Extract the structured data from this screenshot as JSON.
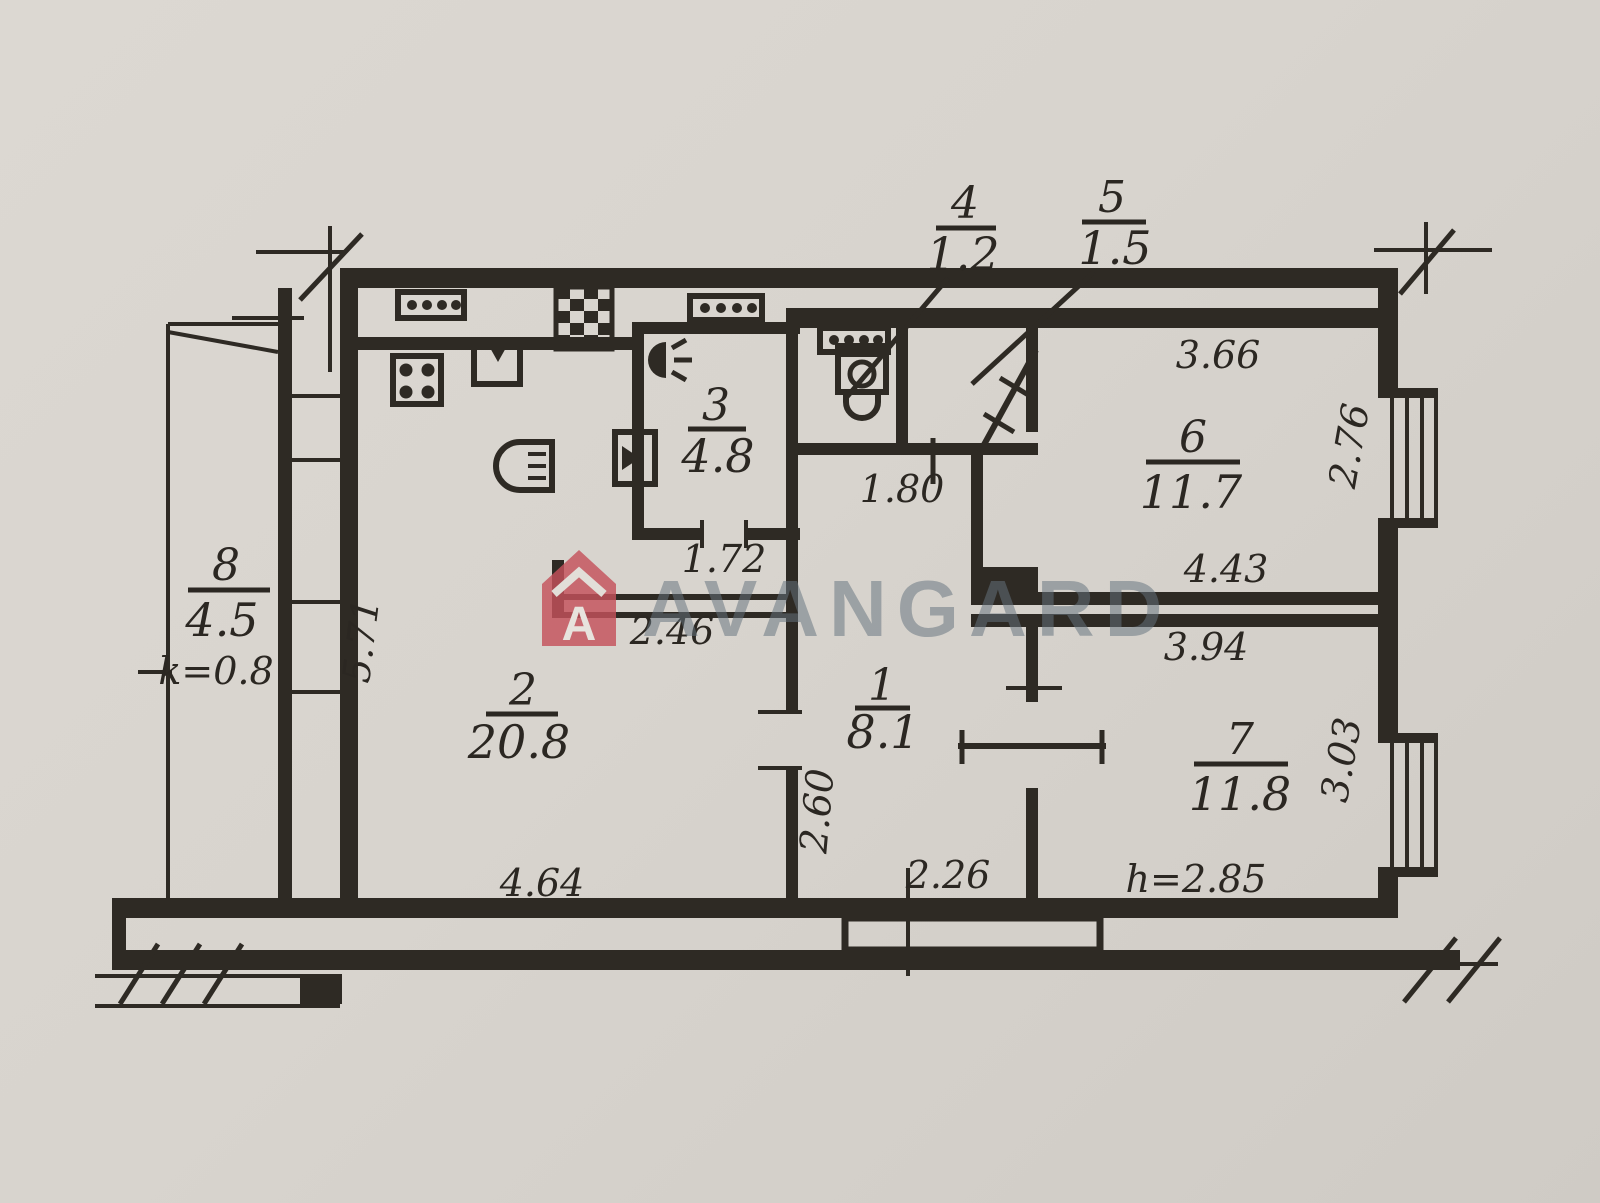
{
  "title": "apartment-floor-plan",
  "watermark": {
    "brand": "AVANGARD",
    "logo_letter": "A"
  },
  "colors": {
    "paper": "#d8d4ce",
    "ink": "#2e2a24",
    "logo_red": "#c4525b",
    "watermark_text": "#66747f"
  },
  "rooms": [
    {
      "id": "1",
      "area": "8.1"
    },
    {
      "id": "2",
      "area": "20.8"
    },
    {
      "id": "3",
      "area": "4.8"
    },
    {
      "id": "4",
      "area": "1.2"
    },
    {
      "id": "5",
      "area": "1.5"
    },
    {
      "id": "6",
      "area": "11.7"
    },
    {
      "id": "7",
      "area": "11.8"
    },
    {
      "id": "8",
      "area": "4.5"
    }
  ],
  "dimensions": {
    "room6_top": "3.66",
    "room6_side": "2.76",
    "room6_bottom": "4.43",
    "room7_top": "3.94",
    "room7_side": "3.03",
    "ceiling_height": "h=2.85",
    "closet_width": "1.80",
    "room3_bottom": "1.72",
    "corridor_width": "2.46",
    "hall_height": "2.60",
    "hall_bottom": "2.26",
    "room2_bottom": "4.64",
    "room2_side": "5.71",
    "balcony_coef": "k=0.8"
  }
}
